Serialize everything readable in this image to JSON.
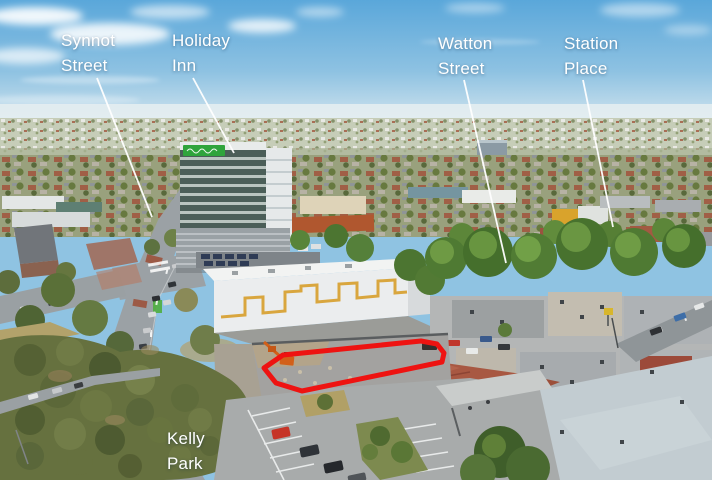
{
  "labels": [
    {
      "id": "synnot-street",
      "line1": "Synnot",
      "line2": "Street"
    },
    {
      "id": "holiday-inn",
      "line1": "Holiday",
      "line2": "Inn"
    },
    {
      "id": "watton-street",
      "line1": "Watton",
      "line2": "Street"
    },
    {
      "id": "station-place",
      "line1": "Station",
      "line2": "Place"
    },
    {
      "id": "kelly-park",
      "line1": "Kelly",
      "line2": "Park"
    }
  ],
  "colors": {
    "label_text": "#ffffff",
    "property_outline": "#ee1311",
    "holiday_inn_sign_green": "#2fa43c",
    "leader_line": "#ffffff"
  }
}
